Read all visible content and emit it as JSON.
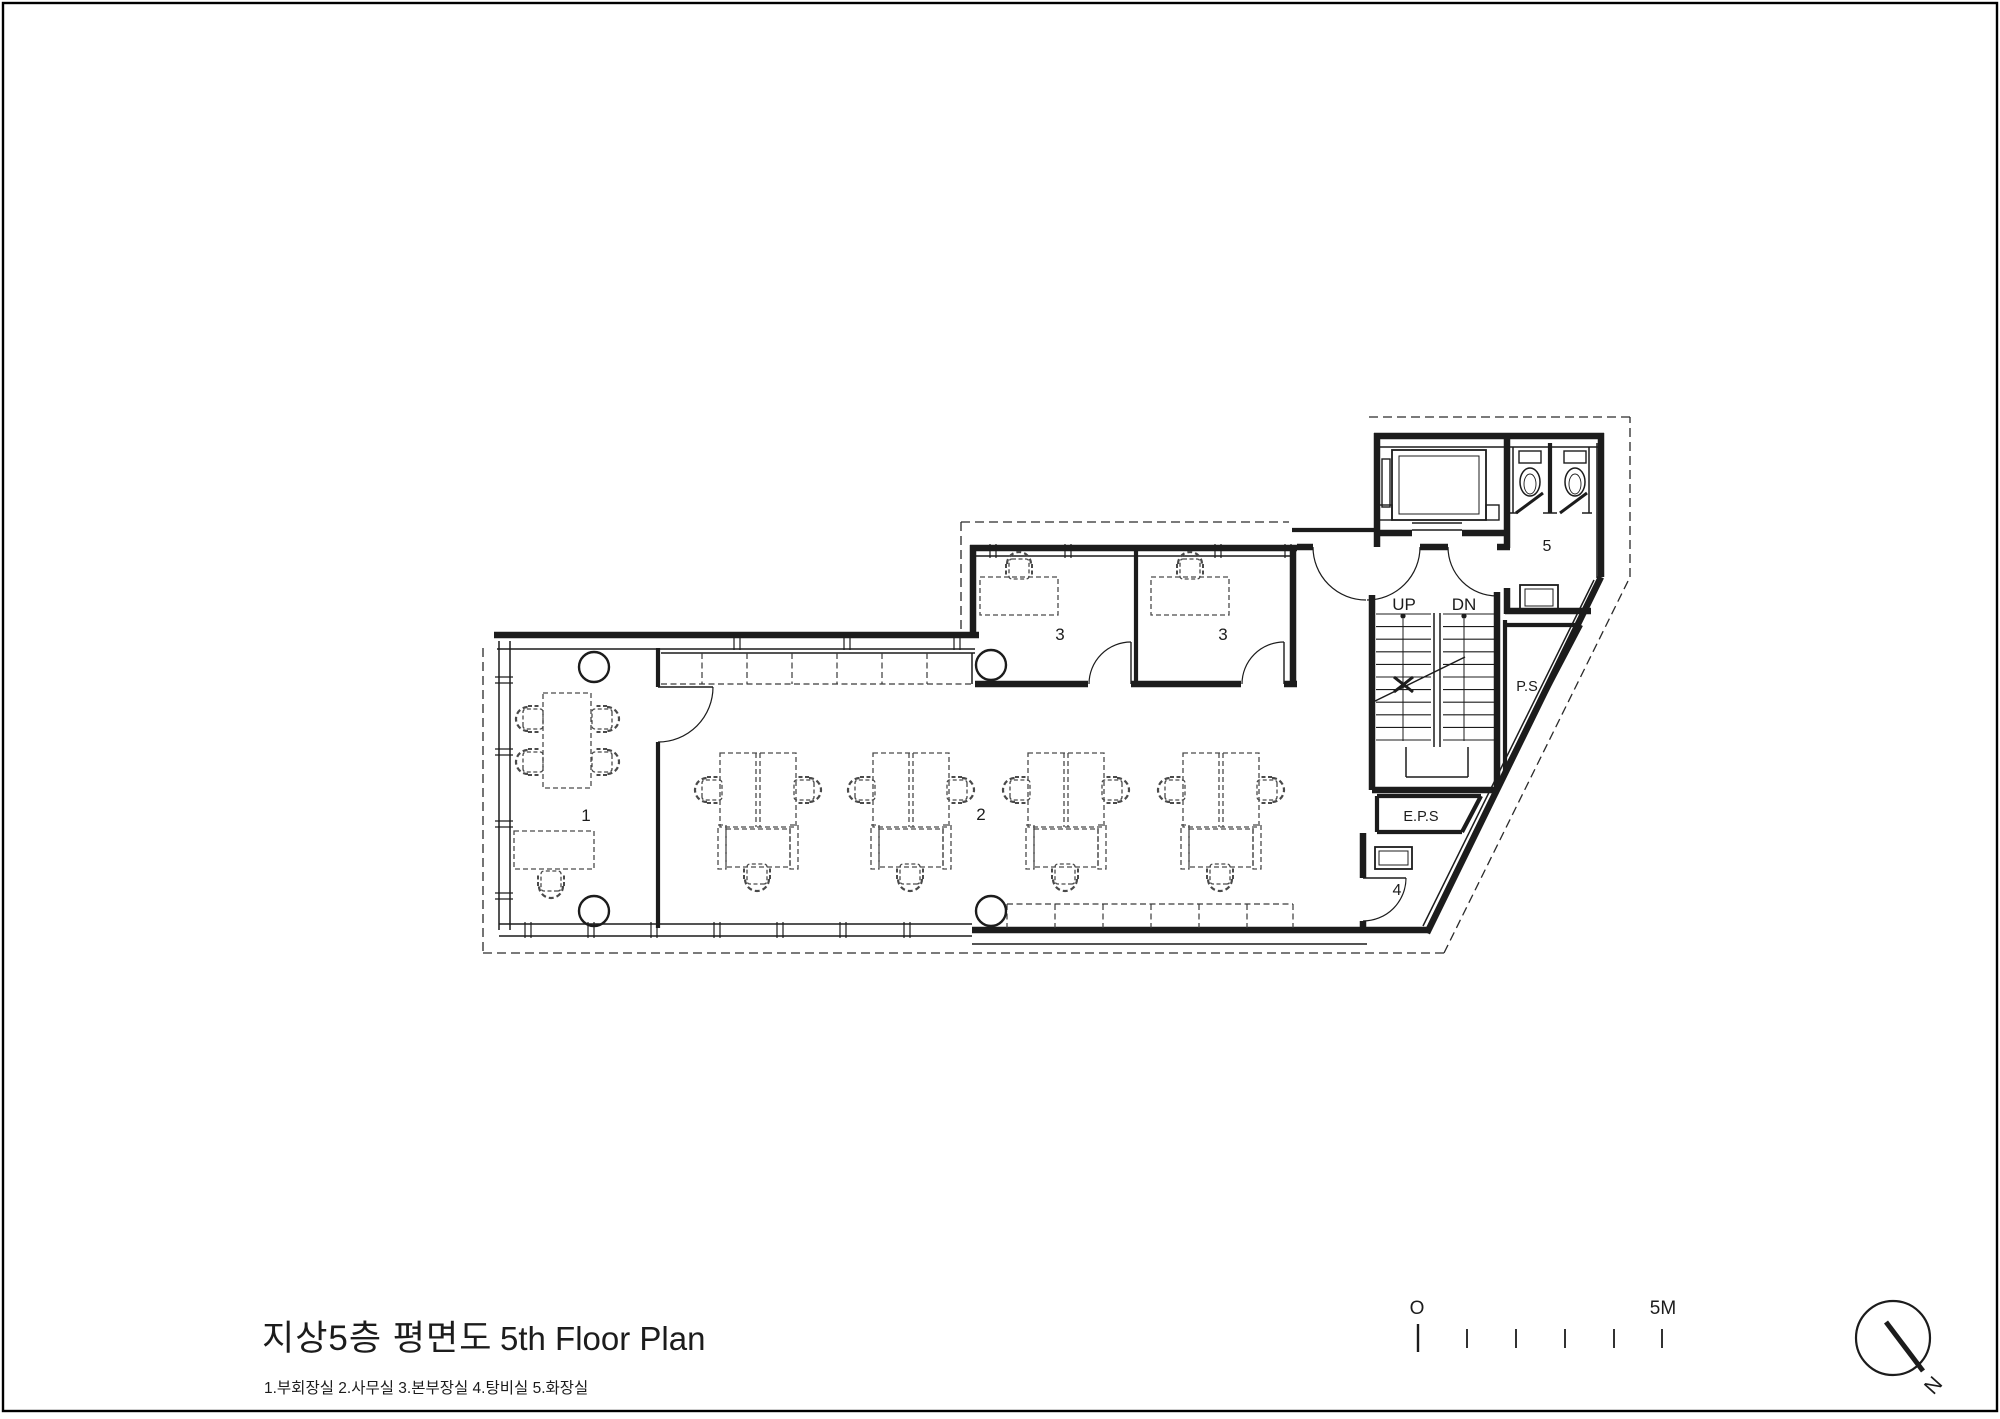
{
  "title": {
    "ko": "지상5층 평면도",
    "en": "5th Floor Plan",
    "legend": "1.부회장실 2.사무실 3.본부장실 4.탕비실 5.화장실"
  },
  "plan": {
    "labels": {
      "r1": "1",
      "r2": "2",
      "r3a": "3",
      "r3b": "3",
      "r4": "4",
      "r5": "5"
    },
    "stair": {
      "up": "UP",
      "dn": "DN"
    },
    "shafts": {
      "ps": "P.S",
      "eps": "E.P.S"
    }
  },
  "scale_bar": {
    "zero": "O",
    "max": "5M"
  },
  "north": {
    "label": "N"
  },
  "colors": {
    "ink": "#1c1c1c",
    "furniture": "#4a4a4a"
  }
}
